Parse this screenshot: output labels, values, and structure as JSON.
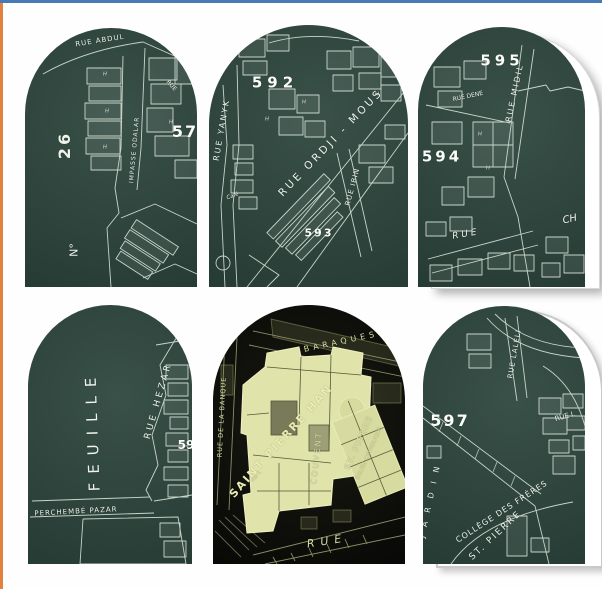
{
  "page": {
    "top_border_color": "#4779b4",
    "left_border_color": "#e2803f",
    "background": "#fefefe"
  },
  "palette": {
    "tile_teal": "#2d463e",
    "tile_black": "#0b0c08",
    "map_line_light": "#e4eee2",
    "map_line_yellow": "#a9ae7d",
    "highlight_yellow": "#e0e3aa",
    "sheet_white": "#ffffff",
    "sheet_shadow": "#c9c9c9"
  },
  "glyphs": {
    "h": "H"
  },
  "tiles": [
    {
      "id": "map-tile-26",
      "labels": {
        "street_abdul": "RUE ABDUL",
        "street_small": "RUE",
        "plate_partial": "57",
        "sheet_no_prefix": "N°",
        "sheet_no": "26",
        "street_impasse": "IMPASSE ODALAR"
      }
    },
    {
      "id": "map-tile-592",
      "labels": {
        "plate": "592",
        "plate2": "593",
        "street_yanyk": "RUE YANYK",
        "street_ordji": "RUE ORDJI - MOUS",
        "street_ibin": "RUE IBIN",
        "cafe": "Café"
      }
    },
    {
      "id": "map-tile-595",
      "labels": {
        "plate": "595",
        "plate2": "594",
        "street_midil": "RUE MIDIL",
        "street_dene": "RUE DENE",
        "street_rue": "RUE",
        "street_ch": "CH"
      }
    },
    {
      "id": "map-tile-feuille",
      "labels": {
        "feuille": "FEUILLE",
        "street_hezar": "RUE HEZAR",
        "street_perchembe": "PERCHEMBÉ PAZAR",
        "plate_partial": "59"
      }
    },
    {
      "id": "map-tile-saint-pierre",
      "labels": {
        "street_banque": "RUE DE LA BANQUE",
        "baraques": "BARAQUES",
        "han": "SAINT PIERRE HAN",
        "vte": "Vte T.",
        "couvent": "COUVENT",
        "st_pierre": "ST. PIERRE",
        "eglise": "ÉGLISE CATHOLIQUE",
        "street_rue": "RUE"
      }
    },
    {
      "id": "map-tile-597",
      "labels": {
        "plate": "597",
        "street_laleli": "RUE LALELI",
        "street_rue_l": "RUE L",
        "college": "COLLÈGE DES FRÈRES",
        "st_pierre": "ST. PIERRE",
        "jardin": "JARDIN"
      }
    }
  ]
}
